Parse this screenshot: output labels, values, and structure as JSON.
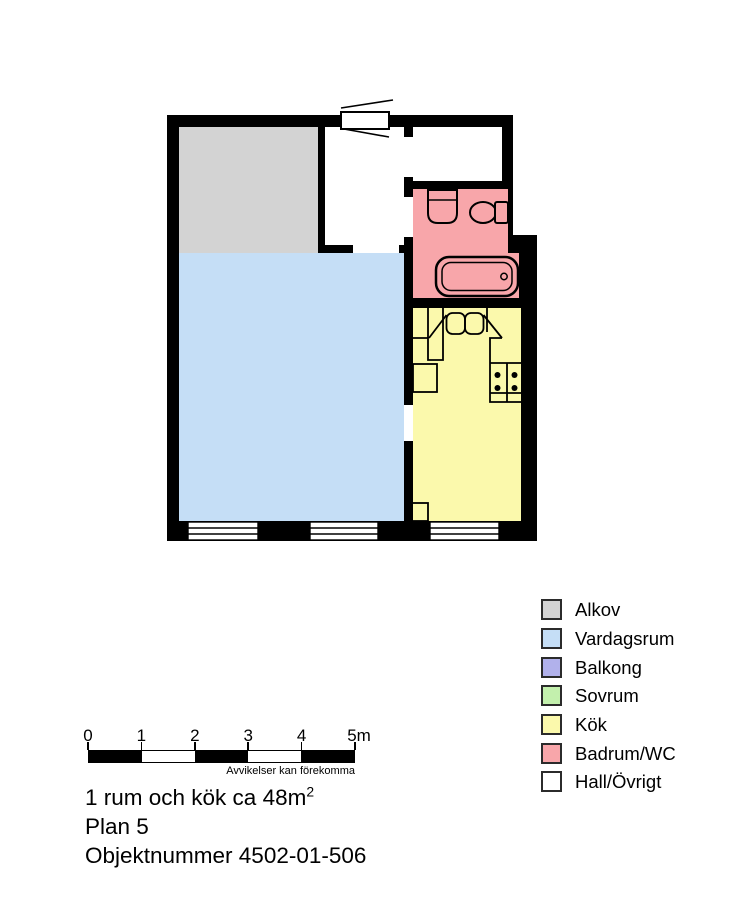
{
  "palette": {
    "wall": "#000000",
    "alkov": "#d3d3d3",
    "vardagsrum": "#c5def6",
    "balkong": "#b1b1eb",
    "sovrum": "#c3f0ad",
    "kok": "#fbf9ac",
    "badrum": "#f8a6aa",
    "hall": "#ffffff"
  },
  "legend": {
    "items": [
      {
        "label": "Alkov",
        "color": "#d3d3d3"
      },
      {
        "label": "Vardagsrum",
        "color": "#c5def6"
      },
      {
        "label": "Balkong",
        "color": "#b1b1eb"
      },
      {
        "label": "Sovrum",
        "color": "#c3f0ad"
      },
      {
        "label": "Kök",
        "color": "#fbf9ac"
      },
      {
        "label": "Badrum/WC",
        "color": "#f8a6aa"
      },
      {
        "label": "Hall/Övrigt",
        "color": "#ffffff"
      }
    ]
  },
  "scale_bar": {
    "ticks": [
      "0",
      "1",
      "2",
      "3",
      "4",
      "5m"
    ],
    "disclaimer": "Avvikelser kan förekomma"
  },
  "info": {
    "line1_main": "1 rum och kök ca 48m",
    "line1_sup": "2",
    "line2": "Plan 5",
    "line3": "Objektnummer 4502-01-506"
  }
}
